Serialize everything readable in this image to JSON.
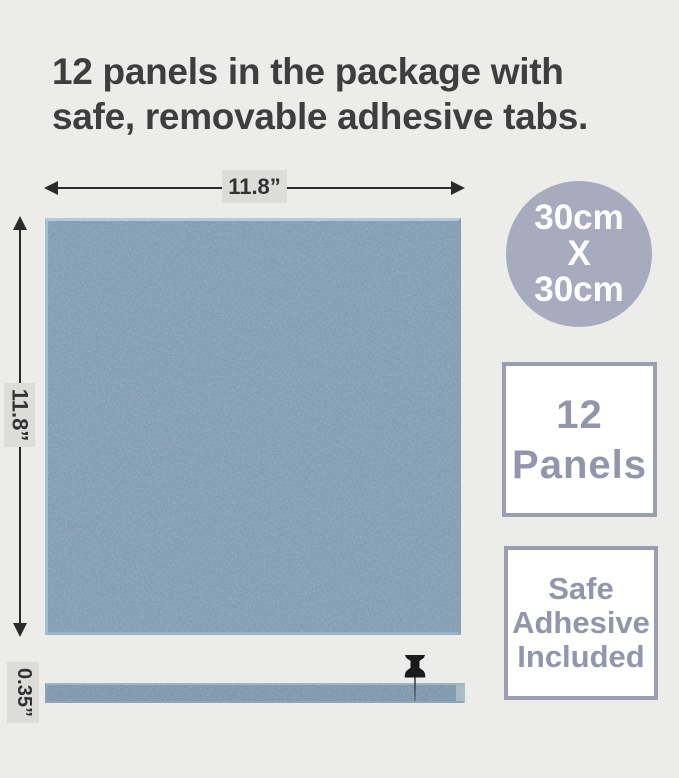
{
  "header": {
    "title_line1": "12 panels in the package with",
    "title_line2": "safe, removable adhesive tabs."
  },
  "dimension_labels": {
    "width": "11.8”",
    "height": "11.8”",
    "thickness": "0.35”"
  },
  "badges": {
    "size_circle": {
      "line1": "30cm",
      "line2": "X",
      "line3": "30cm"
    },
    "panel_count": {
      "line1": "12",
      "line2": "Panels"
    },
    "adhesive": {
      "line1": "Safe",
      "line2": "Adhesive",
      "line3": "Included"
    }
  },
  "icons": {
    "push_pin": "push-pin-icon",
    "arrows": [
      "arrowhead-left-icon",
      "arrowhead-right-icon",
      "arrowhead-up-icon",
      "arrowhead-down-icon"
    ]
  },
  "colors": {
    "background": "#ececea",
    "title_text": "#3e3e3e",
    "dimension_line": "#2b2b2b",
    "dimension_label_bg": "#dcdcda",
    "felt_panel_base": "#7f9cb6",
    "felt_panel_bevel": "#b3cbda",
    "circle_badge_bg": "#a8aabd",
    "circle_badge_text": "#ffffff",
    "badge_border": "#9b9eb2",
    "badge_text": "#9396ab",
    "pin": "#1a1a1a"
  }
}
